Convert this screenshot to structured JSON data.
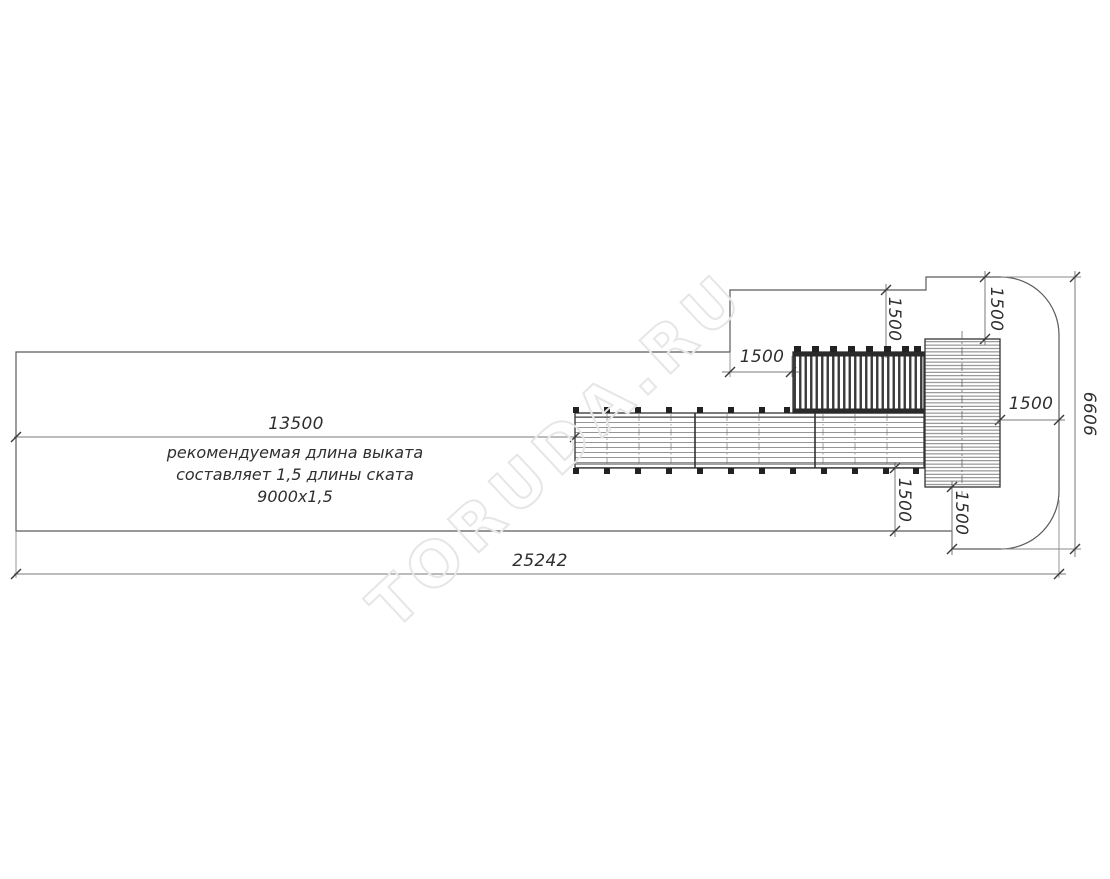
{
  "drawing": {
    "note": {
      "dim": "13500",
      "line1": "рекомендуемая длина выката",
      "line2": "составляет 1,5 длины ската",
      "line3": "9000х1,5"
    },
    "dims": {
      "total_width": "25242",
      "zone_height": "6606",
      "gap_before_ladder": "1500",
      "offset_top_ladder": "1500",
      "offset_top_tower": "1500",
      "offset_right_tower": "1500",
      "offset_bottom_chute": "1500",
      "offset_bottom_tower": "1500"
    },
    "watermark": "TORUDA.RU",
    "colors": {
      "outline": "#5a5a5a",
      "component": "#333333",
      "dim_line": "#7a7a7a",
      "text": "#2f2f2f",
      "watermark": "#e6e6e6"
    }
  }
}
